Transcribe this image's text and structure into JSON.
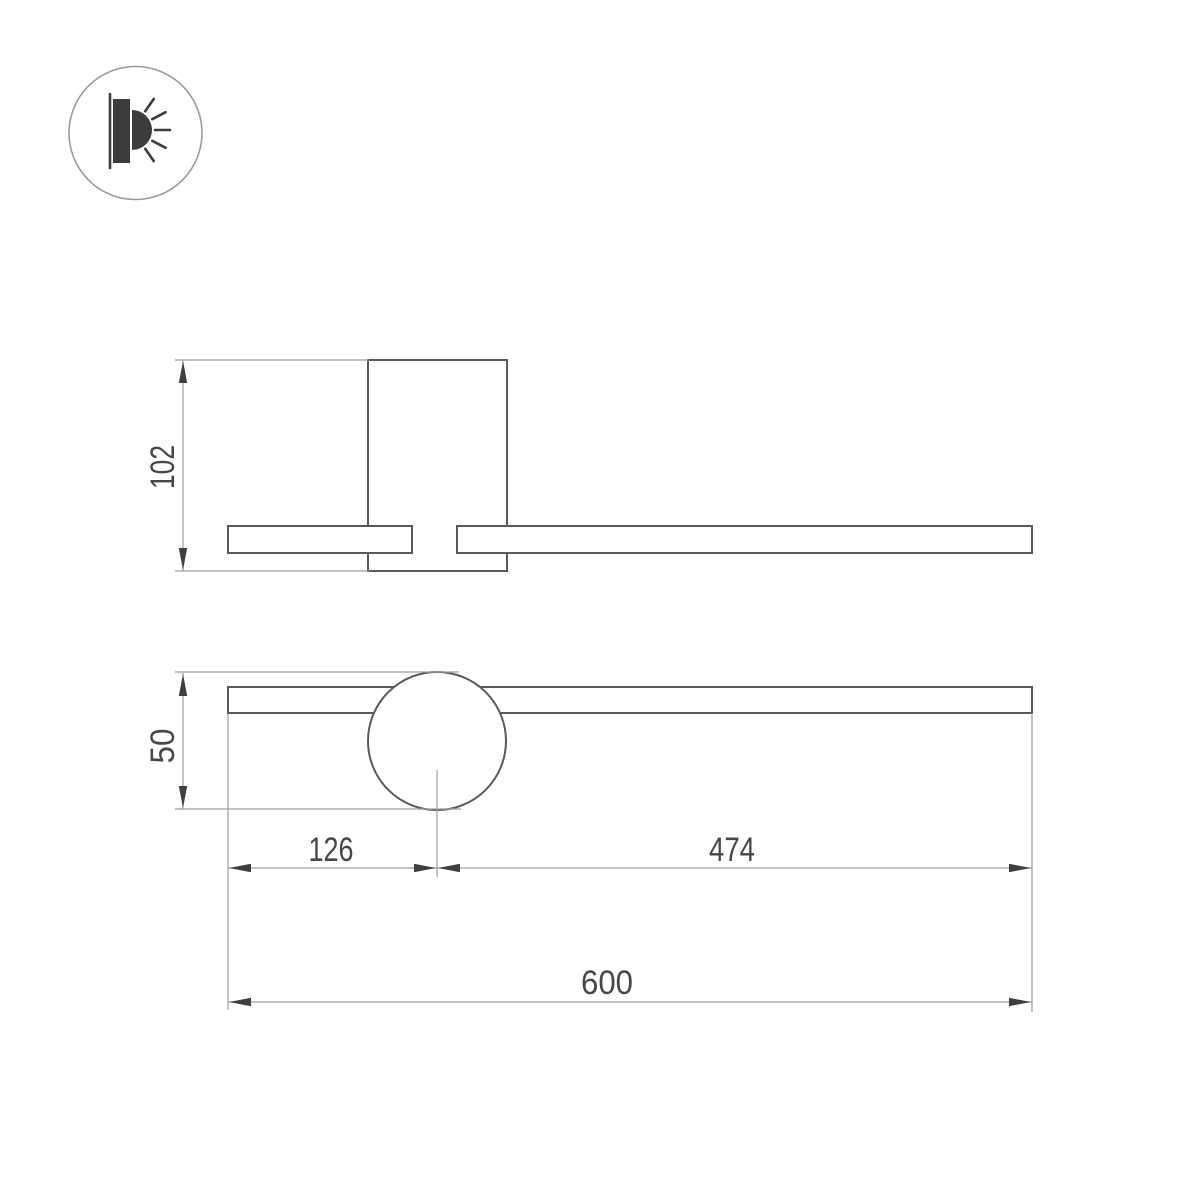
{
  "drawing": {
    "title": "wall-luminaire-dimension-drawing",
    "dimensions": {
      "mount_height": "102",
      "joint_diameter": "50",
      "left_offset": "126",
      "right_span": "474",
      "total_width": "600"
    }
  },
  "icon": {
    "name": "wall-lamp-light-icon"
  },
  "colors": {
    "outline": "#5a5a5a",
    "dim_line": "#9e9e9e",
    "arrow": "#3f3f3f",
    "text": "#474747",
    "icon_dark": "#3c3c3c",
    "icon_ring": "#9b9b9b",
    "background": "#ffffff"
  }
}
